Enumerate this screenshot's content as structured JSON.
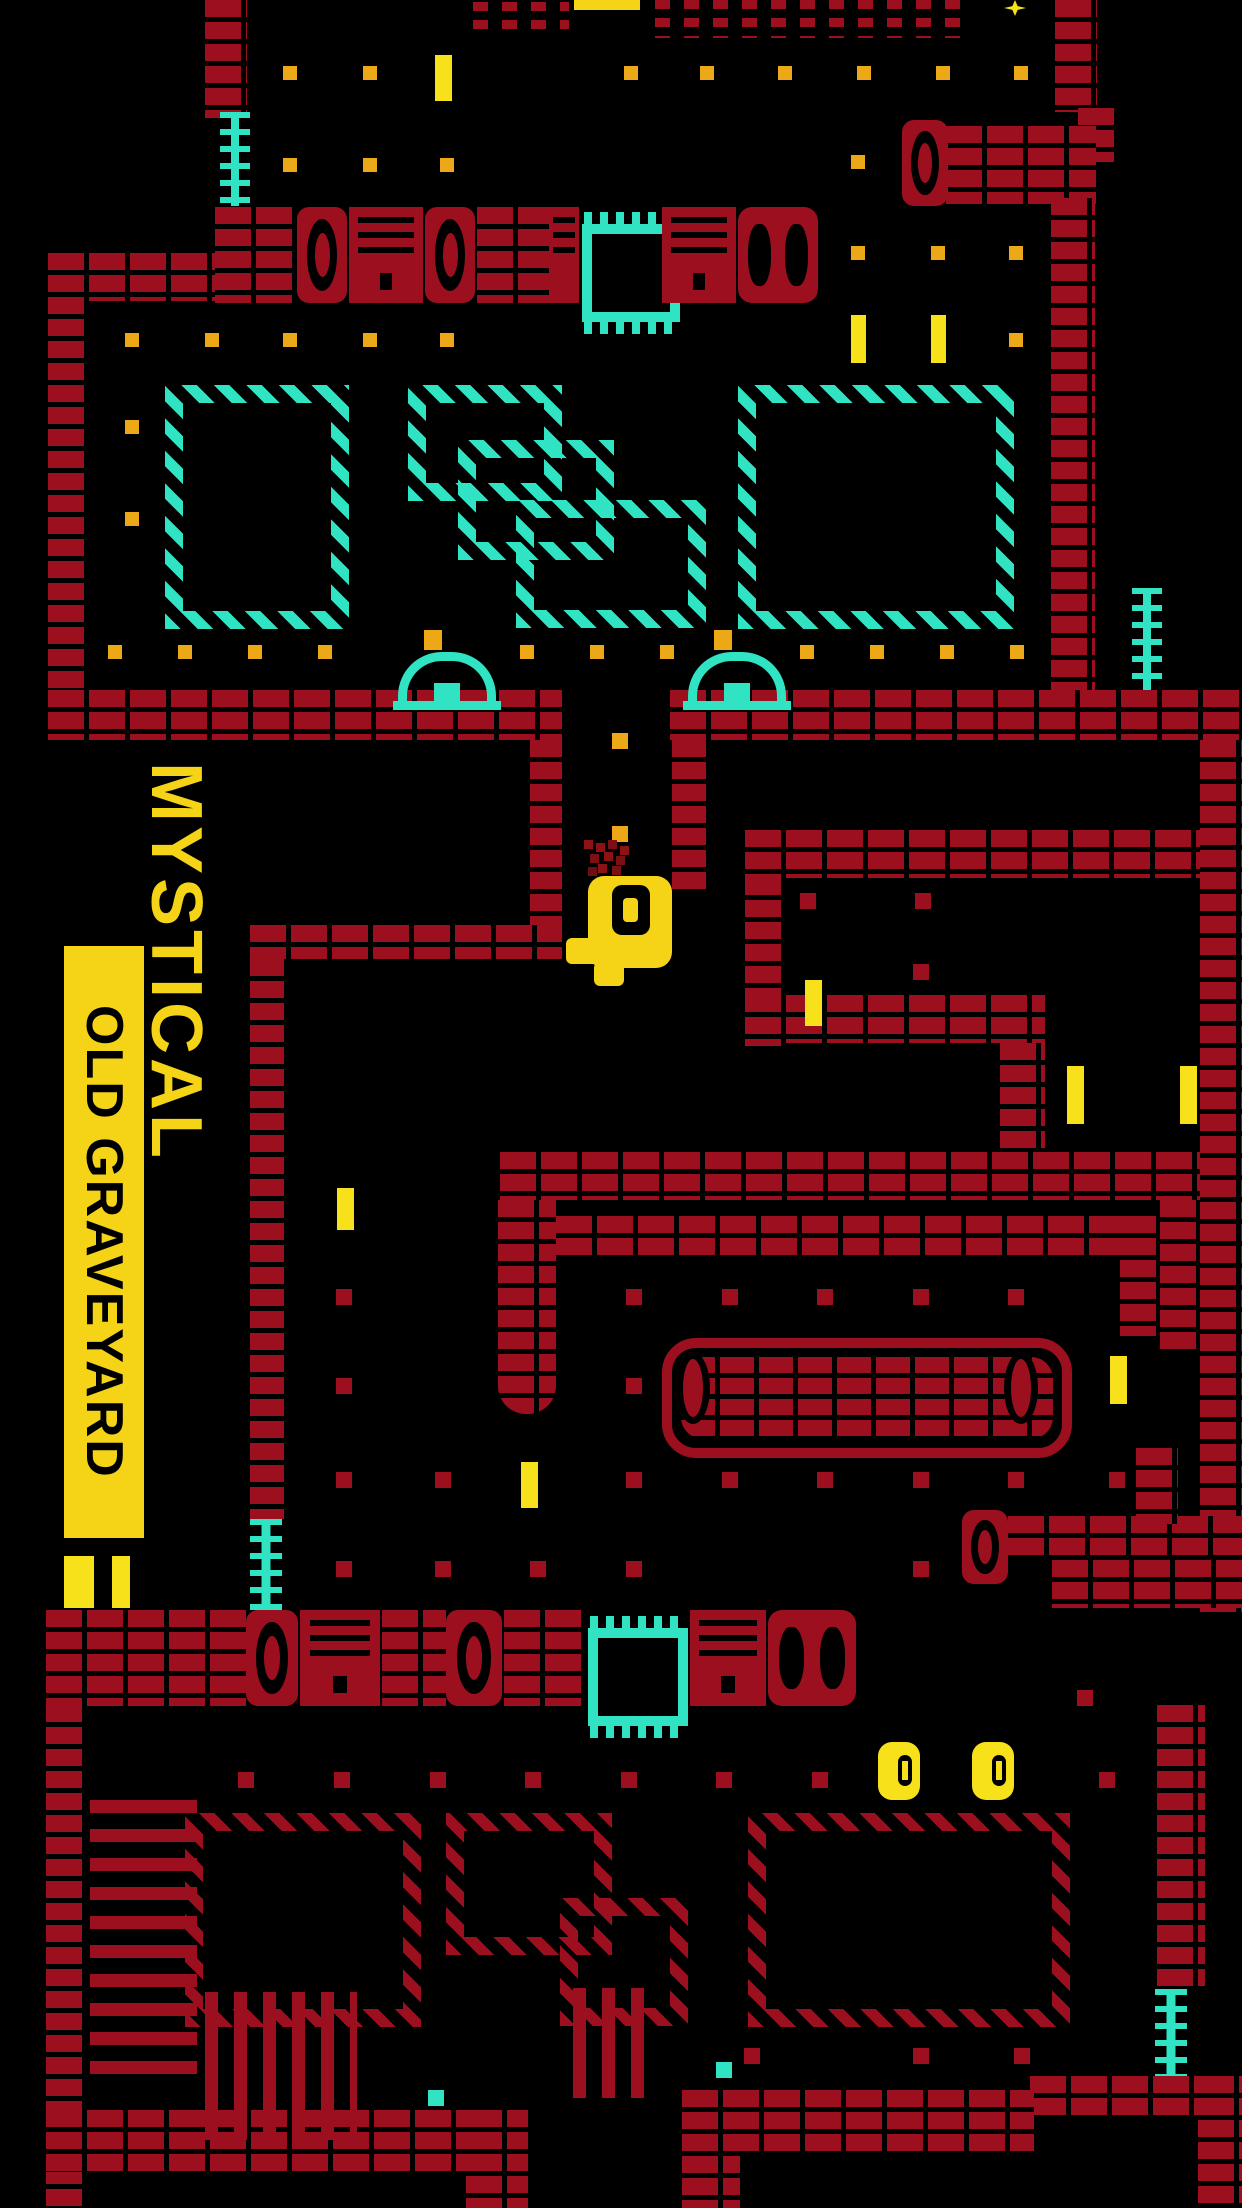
{
  "game": {
    "title": "MYSTICAL",
    "level_name": "OLD GRAVEYARD"
  },
  "colors": {
    "background": "#000000",
    "brick_red": "#9c0f1e",
    "cyan": "#2fe3c3",
    "amber_dot": "#eca816",
    "yellow": "#f5d418",
    "bright_yellow": "#f7e11a"
  },
  "legend": {
    "entity_format": [
      "type",
      "x",
      "y",
      "w",
      "h",
      "extra-class"
    ],
    "types": {
      "w": "brick-wall",
      "cr": "ruined-wall",
      "t": "tombstone",
      "h2": "double-tombstone",
      "sl": "engraved-slab",
      "cb": "comb-gate",
      "hx": "hatched-platform-cyan",
      "hr": "hatched-platform-red",
      "ld": "ladder",
      "dm": "grave-dome",
      "da": "amber-dot",
      "dr": "red-dot",
      "dc": "cyan-dot",
      "yb": "yellow-bar",
      "cn": "coin",
      "fh": "fence-horizontal",
      "fv": "fence-vertical",
      "sc": "sarcophagus",
      "cp": "sarcophagus-end",
      "sp": "player-sprite",
      "sp2": "player-foot",
      "pt": "particle-burst",
      "st": "star-sprite",
      "yc": "clipped-banner"
    }
  },
  "entities": [
    [
      "w",
      205,
      0,
      42,
      118
    ],
    [
      "w",
      48,
      253,
      40,
      487
    ],
    [
      "w",
      48,
      253,
      170,
      48
    ],
    [
      "cr",
      655,
      0,
      318,
      38
    ],
    [
      "cr",
      473,
      2,
      96,
      34
    ],
    [
      "w",
      1055,
      0,
      42,
      112
    ],
    [
      "w",
      1078,
      108,
      40,
      54
    ],
    [
      "w",
      946,
      126,
      150,
      78
    ],
    [
      "t",
      902,
      120,
      46,
      86
    ],
    [
      "w",
      1051,
      198,
      44,
      494
    ],
    [
      "w",
      48,
      690,
      514,
      50
    ],
    [
      "w",
      670,
      690,
      572,
      50
    ],
    [
      "w",
      530,
      740,
      32,
      218
    ],
    [
      "w",
      250,
      925,
      312,
      34
    ],
    [
      "w",
      250,
      959,
      34,
      560
    ],
    [
      "ld",
      250,
      1519,
      32,
      92
    ],
    [
      "w",
      672,
      740,
      34,
      154
    ],
    [
      "w",
      745,
      830,
      465,
      48
    ],
    [
      "w",
      745,
      878,
      40,
      168
    ],
    [
      "w",
      745,
      995,
      300,
      48
    ],
    [
      "w",
      1000,
      1043,
      45,
      112
    ],
    [
      "w",
      1200,
      740,
      42,
      872
    ],
    [
      "w",
      500,
      1152,
      700,
      48
    ],
    [
      "w",
      556,
      1216,
      570,
      40
    ],
    [
      "w",
      498,
      1200,
      58,
      214,
      "rb"
    ],
    [
      "w",
      1160,
      1200,
      40,
      152
    ],
    [
      "w",
      1120,
      1216,
      40,
      120
    ],
    [
      "w",
      1008,
      1516,
      234,
      44
    ],
    [
      "t",
      962,
      1510,
      46,
      74
    ],
    [
      "w",
      1136,
      1448,
      42,
      76
    ],
    [
      "w",
      1052,
      1560,
      190,
      48
    ],
    [
      "w",
      46,
      1705,
      40,
      503
    ],
    [
      "w",
      1157,
      1705,
      48,
      284
    ],
    [
      "ld",
      1155,
      1989,
      32,
      88
    ],
    [
      "w",
      1030,
      2076,
      212,
      44
    ],
    [
      "w",
      1198,
      2076,
      44,
      132
    ],
    [
      "w",
      46,
      2110,
      482,
      62
    ],
    [
      "w",
      466,
      2110,
      62,
      98
    ],
    [
      "w",
      682,
      2090,
      352,
      62
    ],
    [
      "w",
      682,
      2090,
      58,
      118
    ],
    [
      "w",
      215,
      207,
      82,
      96
    ],
    [
      "t",
      297,
      207,
      50,
      96
    ],
    [
      "sl",
      349,
      207,
      74,
      96
    ],
    [
      "t",
      425,
      207,
      50,
      96
    ],
    [
      "w",
      477,
      207,
      72,
      96
    ],
    [
      "sl",
      549,
      207,
      30,
      96
    ],
    [
      "cb",
      582,
      224,
      78,
      78
    ],
    [
      "sl",
      662,
      207,
      74,
      96
    ],
    [
      "h2",
      738,
      207,
      80,
      96
    ],
    [
      "w",
      46,
      1610,
      200,
      96
    ],
    [
      "t",
      246,
      1610,
      52,
      96
    ],
    [
      "sl",
      300,
      1610,
      80,
      96
    ],
    [
      "w",
      382,
      1610,
      64,
      96
    ],
    [
      "t",
      446,
      1610,
      56,
      96
    ],
    [
      "w",
      504,
      1610,
      80,
      96
    ],
    [
      "cb",
      588,
      1628,
      80,
      78
    ],
    [
      "sl",
      690,
      1610,
      76,
      96
    ],
    [
      "h2",
      768,
      1610,
      88,
      96
    ],
    [
      "hx",
      165,
      385,
      148,
      208
    ],
    [
      "hx",
      408,
      385,
      118,
      80
    ],
    [
      "hx",
      458,
      440,
      120,
      84
    ],
    [
      "hx",
      516,
      500,
      154,
      92
    ],
    [
      "hx",
      738,
      385,
      240,
      208
    ],
    [
      "hr",
      185,
      1813,
      200,
      178
    ],
    [
      "hr",
      446,
      1813,
      130,
      106
    ],
    [
      "hr",
      560,
      1898,
      92,
      92
    ],
    [
      "hr",
      748,
      1813,
      286,
      178
    ],
    [
      "ld",
      220,
      112,
      30,
      94
    ],
    [
      "ld",
      1132,
      588,
      30,
      102
    ],
    [
      "dm",
      398,
      652,
      80,
      40
    ],
    [
      "da",
      424,
      630,
      18,
      20
    ],
    [
      "dm",
      688,
      652,
      80,
      40
    ],
    [
      "da",
      714,
      630,
      18,
      20
    ],
    [
      "sc",
      662,
      1338,
      390,
      100
    ],
    [
      "cp",
      676,
      1352,
      34,
      72
    ],
    [
      "cp",
      1004,
      1352,
      34,
      72
    ],
    [
      "fh",
      90,
      1800,
      107,
      278
    ],
    [
      "fv",
      205,
      1992,
      152,
      148
    ],
    [
      "fv",
      573,
      1988,
      78,
      110
    ],
    [
      "st",
      1004,
      0,
      22,
      16
    ],
    [
      "yc",
      574,
      0,
      66,
      10
    ],
    [
      "da",
      283,
      66,
      14,
      14
    ],
    [
      "da",
      363,
      66,
      14,
      14
    ],
    [
      "da",
      624,
      66,
      14,
      14
    ],
    [
      "da",
      700,
      66,
      14,
      14
    ],
    [
      "da",
      778,
      66,
      14,
      14
    ],
    [
      "da",
      857,
      66,
      14,
      14
    ],
    [
      "da",
      936,
      66,
      14,
      14
    ],
    [
      "da",
      1014,
      66,
      14,
      14
    ],
    [
      "da",
      283,
      158,
      14,
      14
    ],
    [
      "da",
      363,
      158,
      14,
      14
    ],
    [
      "da",
      440,
      158,
      14,
      14
    ],
    [
      "da",
      851,
      155,
      14,
      14
    ],
    [
      "da",
      851,
      246,
      14,
      14
    ],
    [
      "da",
      931,
      246,
      14,
      14
    ],
    [
      "da",
      1009,
      246,
      14,
      14
    ],
    [
      "da",
      125,
      333,
      14,
      14
    ],
    [
      "da",
      205,
      333,
      14,
      14
    ],
    [
      "da",
      283,
      333,
      14,
      14
    ],
    [
      "da",
      363,
      333,
      14,
      14
    ],
    [
      "da",
      440,
      333,
      14,
      14
    ],
    [
      "da",
      1009,
      333,
      14,
      14
    ],
    [
      "da",
      125,
      420,
      14,
      14
    ],
    [
      "da",
      125,
      512,
      14,
      14
    ],
    [
      "da",
      108,
      645,
      14,
      14
    ],
    [
      "da",
      178,
      645,
      14,
      14
    ],
    [
      "da",
      248,
      645,
      14,
      14
    ],
    [
      "da",
      318,
      645,
      14,
      14
    ],
    [
      "da",
      520,
      645,
      14,
      14
    ],
    [
      "da",
      590,
      645,
      14,
      14
    ],
    [
      "da",
      660,
      645,
      14,
      14
    ],
    [
      "da",
      800,
      645,
      14,
      14
    ],
    [
      "da",
      870,
      645,
      14,
      14
    ],
    [
      "da",
      940,
      645,
      14,
      14
    ],
    [
      "da",
      1010,
      645,
      14,
      14
    ],
    [
      "da",
      612,
      733,
      16,
      16
    ],
    [
      "da",
      612,
      826,
      16,
      16
    ],
    [
      "yb",
      435,
      55,
      17,
      46
    ],
    [
      "yb",
      851,
      315,
      15,
      48
    ],
    [
      "yb",
      931,
      315,
      15,
      48
    ],
    [
      "yb",
      805,
      980,
      17,
      46
    ],
    [
      "yb",
      1067,
      1066,
      17,
      58
    ],
    [
      "yb",
      1180,
      1066,
      17,
      58
    ],
    [
      "yb",
      337,
      1188,
      17,
      42
    ],
    [
      "yb",
      1110,
      1356,
      17,
      48
    ],
    [
      "yb",
      521,
      1462,
      17,
      46
    ],
    [
      "yb",
      64,
      1556,
      30,
      52
    ],
    [
      "yb",
      112,
      1556,
      18,
      52
    ],
    [
      "dr",
      800,
      893,
      16,
      16
    ],
    [
      "dr",
      915,
      893,
      16,
      16
    ],
    [
      "dr",
      913,
      964,
      16,
      16
    ],
    [
      "dr",
      336,
      1289,
      16,
      16
    ],
    [
      "dr",
      626,
      1289,
      16,
      16
    ],
    [
      "dr",
      722,
      1289,
      16,
      16
    ],
    [
      "dr",
      817,
      1289,
      16,
      16
    ],
    [
      "dr",
      913,
      1289,
      16,
      16
    ],
    [
      "dr",
      1008,
      1289,
      16,
      16
    ],
    [
      "dr",
      336,
      1378,
      16,
      16
    ],
    [
      "dr",
      626,
      1378,
      16,
      16
    ],
    [
      "dr",
      336,
      1472,
      16,
      16
    ],
    [
      "dr",
      435,
      1472,
      16,
      16
    ],
    [
      "dr",
      626,
      1472,
      16,
      16
    ],
    [
      "dr",
      722,
      1472,
      16,
      16
    ],
    [
      "dr",
      817,
      1472,
      16,
      16
    ],
    [
      "dr",
      913,
      1472,
      16,
      16
    ],
    [
      "dr",
      1008,
      1472,
      16,
      16
    ],
    [
      "dr",
      1109,
      1472,
      16,
      16
    ],
    [
      "dr",
      336,
      1561,
      16,
      16
    ],
    [
      "dr",
      435,
      1561,
      16,
      16
    ],
    [
      "dr",
      530,
      1561,
      16,
      16
    ],
    [
      "dr",
      626,
      1561,
      16,
      16
    ],
    [
      "dr",
      913,
      1561,
      16,
      16
    ],
    [
      "dr",
      1077,
      1690,
      16,
      16
    ],
    [
      "dr",
      238,
      1772,
      16,
      16
    ],
    [
      "dr",
      334,
      1772,
      16,
      16
    ],
    [
      "dr",
      430,
      1772,
      16,
      16
    ],
    [
      "dr",
      525,
      1772,
      16,
      16
    ],
    [
      "dr",
      621,
      1772,
      16,
      16
    ],
    [
      "dr",
      716,
      1772,
      16,
      16
    ],
    [
      "dr",
      812,
      1772,
      16,
      16
    ],
    [
      "dr",
      1099,
      1772,
      16,
      16
    ],
    [
      "dr",
      744,
      2048,
      16,
      16
    ],
    [
      "dr",
      913,
      2048,
      16,
      16
    ],
    [
      "dr",
      1014,
      2048,
      16,
      16
    ],
    [
      "dc",
      428,
      2090,
      16,
      16
    ],
    [
      "dc",
      716,
      2062,
      16,
      16
    ],
    [
      "cn",
      878,
      1742,
      42,
      58
    ],
    [
      "cn",
      972,
      1742,
      42,
      58
    ],
    [
      "pt",
      584,
      840,
      48,
      38
    ],
    [
      "sp",
      588,
      876,
      84,
      92
    ],
    [
      "sp2",
      566,
      938,
      36,
      26
    ],
    [
      "sp2",
      594,
      962,
      30,
      24
    ]
  ]
}
